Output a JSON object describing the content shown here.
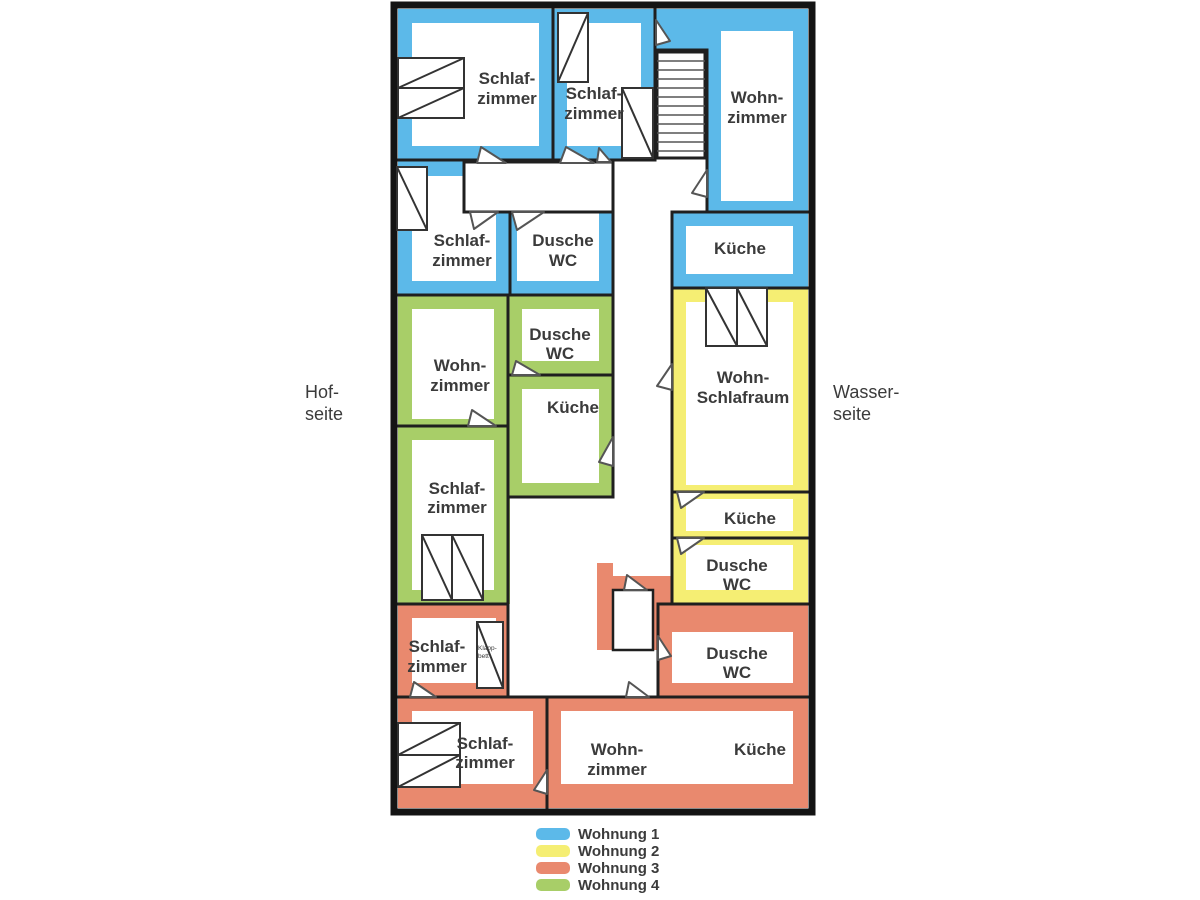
{
  "plan": {
    "side_labels": {
      "left": {
        "l1": "Hof-",
        "l2": "seite"
      },
      "right": {
        "l1": "Wasser-",
        "l2": "seite"
      }
    },
    "rooms": [
      {
        "id": "sz1",
        "l1": "Schlaf-",
        "l2": "zimmer"
      },
      {
        "id": "sz2",
        "l1": "Schlaf-",
        "l2": "zimmer"
      },
      {
        "id": "wz1",
        "l1": "Wohn-",
        "l2": "zimmer"
      },
      {
        "id": "sz3",
        "l1": "Schlaf-",
        "l2": "zimmer"
      },
      {
        "id": "du1",
        "l1": "Dusche",
        "l2": "WC"
      },
      {
        "id": "ku1",
        "l1": "Küche"
      },
      {
        "id": "wz4",
        "l1": "Wohn-",
        "l2": "zimmer"
      },
      {
        "id": "du4",
        "l1": "Dusche",
        "l2": "WC"
      },
      {
        "id": "ku4",
        "l1": "Küche"
      },
      {
        "id": "sz4",
        "l1": "Schlaf-",
        "l2": "zimmer"
      },
      {
        "id": "wsr",
        "l1": "Wohn-",
        "l2": "Schlafraum"
      },
      {
        "id": "ku2",
        "l1": "Küche"
      },
      {
        "id": "du2",
        "l1": "Dusche",
        "l2": "WC"
      },
      {
        "id": "sz5",
        "l1": "Schlaf-",
        "l2": "zimmer"
      },
      {
        "id": "du3",
        "l1": "Dusche",
        "l2": "WC"
      },
      {
        "id": "sz6",
        "l1": "Schlaf-",
        "l2": "zimmer"
      },
      {
        "id": "wz3",
        "l1": "Wohn-",
        "l2": "zimmer"
      },
      {
        "id": "ku3",
        "l1": "Küche"
      }
    ],
    "closet_label": {
      "l1": "Klapp-",
      "l2": "bett"
    }
  },
  "apartments": [
    {
      "name": "Wohnung 1",
      "color": "#5CB9E9"
    },
    {
      "name": "Wohnung 2",
      "color": "#F5EE73"
    },
    {
      "name": "Wohnung 3",
      "color": "#E9896E"
    },
    {
      "name": "Wohnung 4",
      "color": "#A8CE68"
    }
  ],
  "legend": {
    "items": [
      {
        "label": "Wohnung 1"
      },
      {
        "label": "Wohnung 2"
      },
      {
        "label": "Wohnung 3"
      },
      {
        "label": "Wohnung 4"
      }
    ]
  }
}
